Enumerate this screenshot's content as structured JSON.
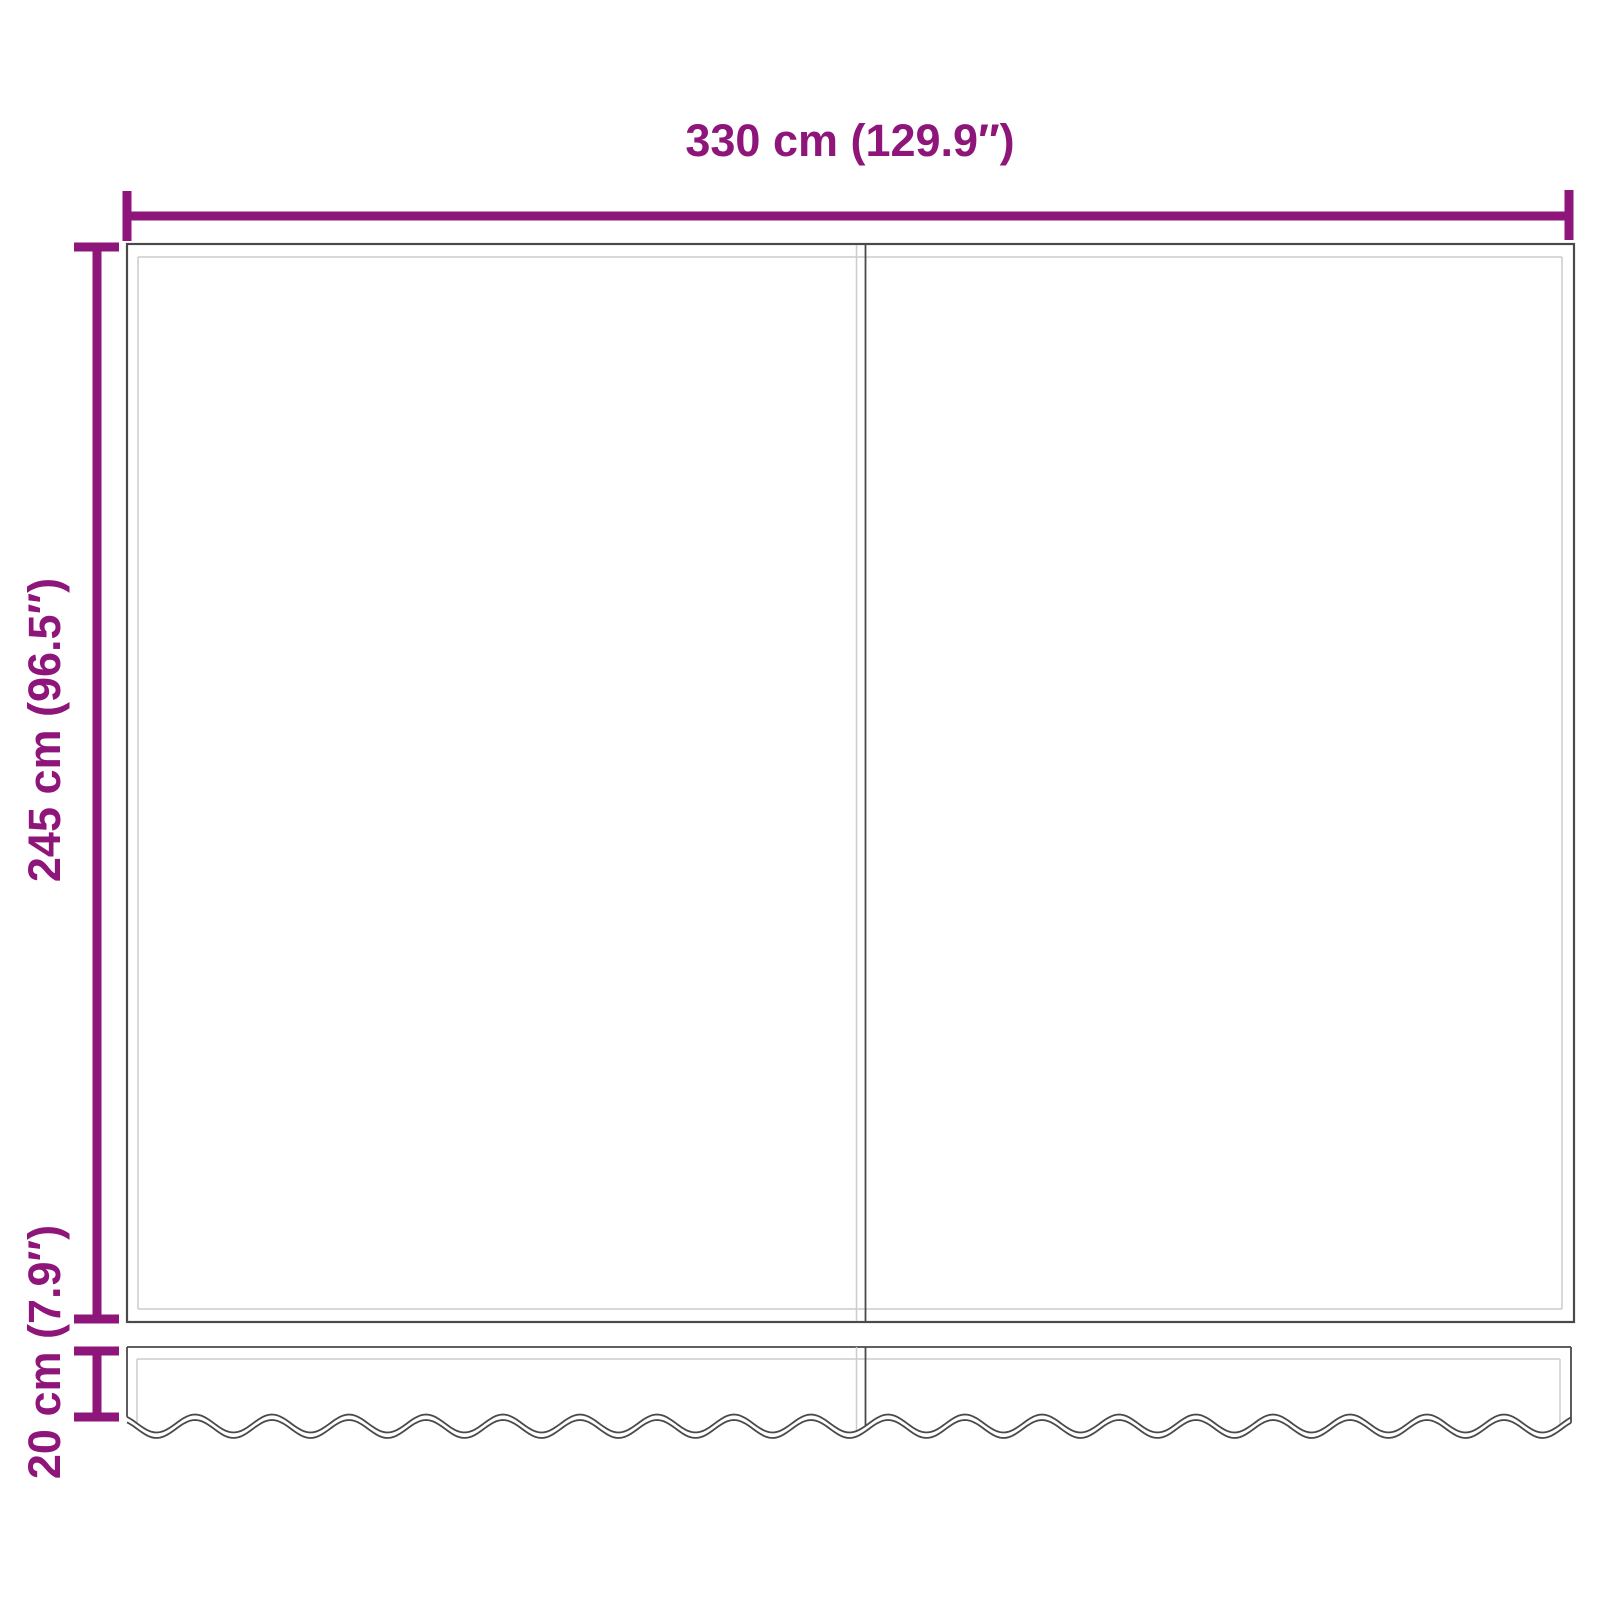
{
  "diagram": {
    "labels": {
      "width": "330 cm (129.9″)",
      "height": "245 cm (96.5″)",
      "valance": "20 cm (7.9″)"
    },
    "colors": {
      "dimension": "#8E1579",
      "outline": "#4A4A4A",
      "hem": "#CCCCCC",
      "background": "#FFFFFF"
    }
  }
}
